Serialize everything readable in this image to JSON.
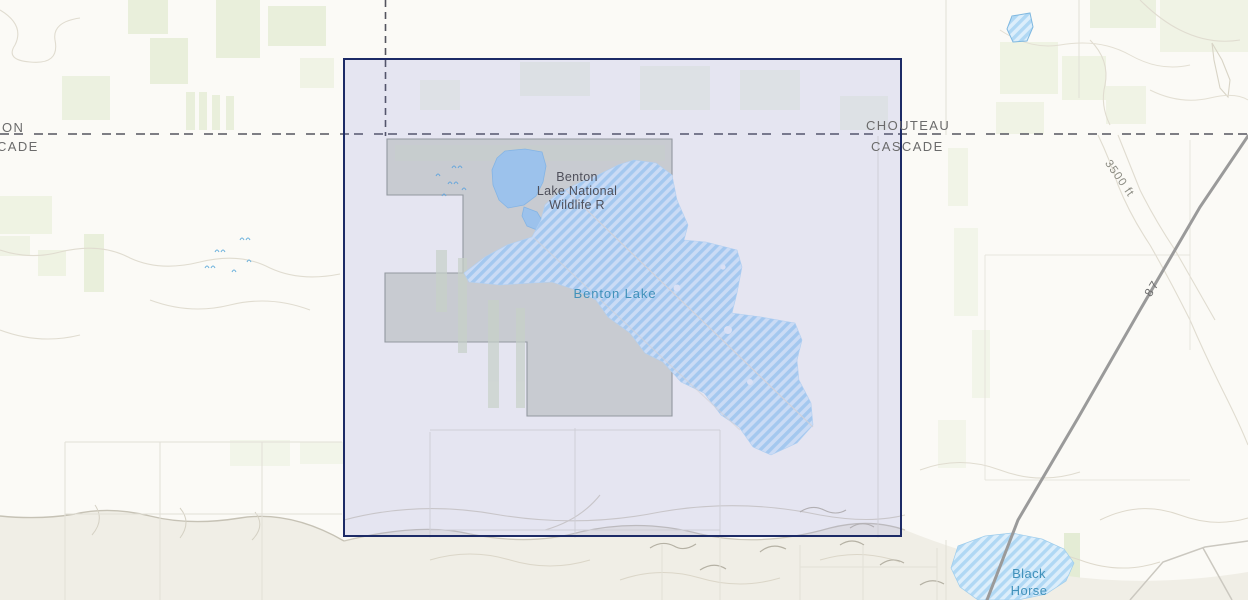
{
  "map": {
    "county_boundary": {
      "left_top": "ON",
      "left_bottom": "CADE",
      "right_top": "CHOUTEAU",
      "right_bottom": "CASCADE"
    },
    "features": {
      "refuge_name_lines": [
        "Benton",
        "Lake National",
        "Wildlife R"
      ],
      "lake_name": "Benton Lake",
      "black_horse_lake_lines": [
        "Black",
        "Horse",
        "Lake"
      ],
      "contour_elevation_label": "3500 ft",
      "highway_label": "87"
    },
    "colors": {
      "selection_border": "#1c2a66",
      "selection_fill": "rgba(88,94,210,0.13)",
      "lake_hatch_dark": "#b0d8f4",
      "lake_hatch_light": "#dceefb",
      "pond_fill": "#a7d2f1",
      "refuge_fill": "#d2d6cb",
      "water_label_color": "#4191ba",
      "refuge_label_color": "#4f505b",
      "county_label_color": "#6b6b6b",
      "county_line_color": "#54545e",
      "highway_color": "#9a9a9a",
      "field_green": "#e9efdb",
      "contour_tan": "#e0dcd0"
    }
  }
}
